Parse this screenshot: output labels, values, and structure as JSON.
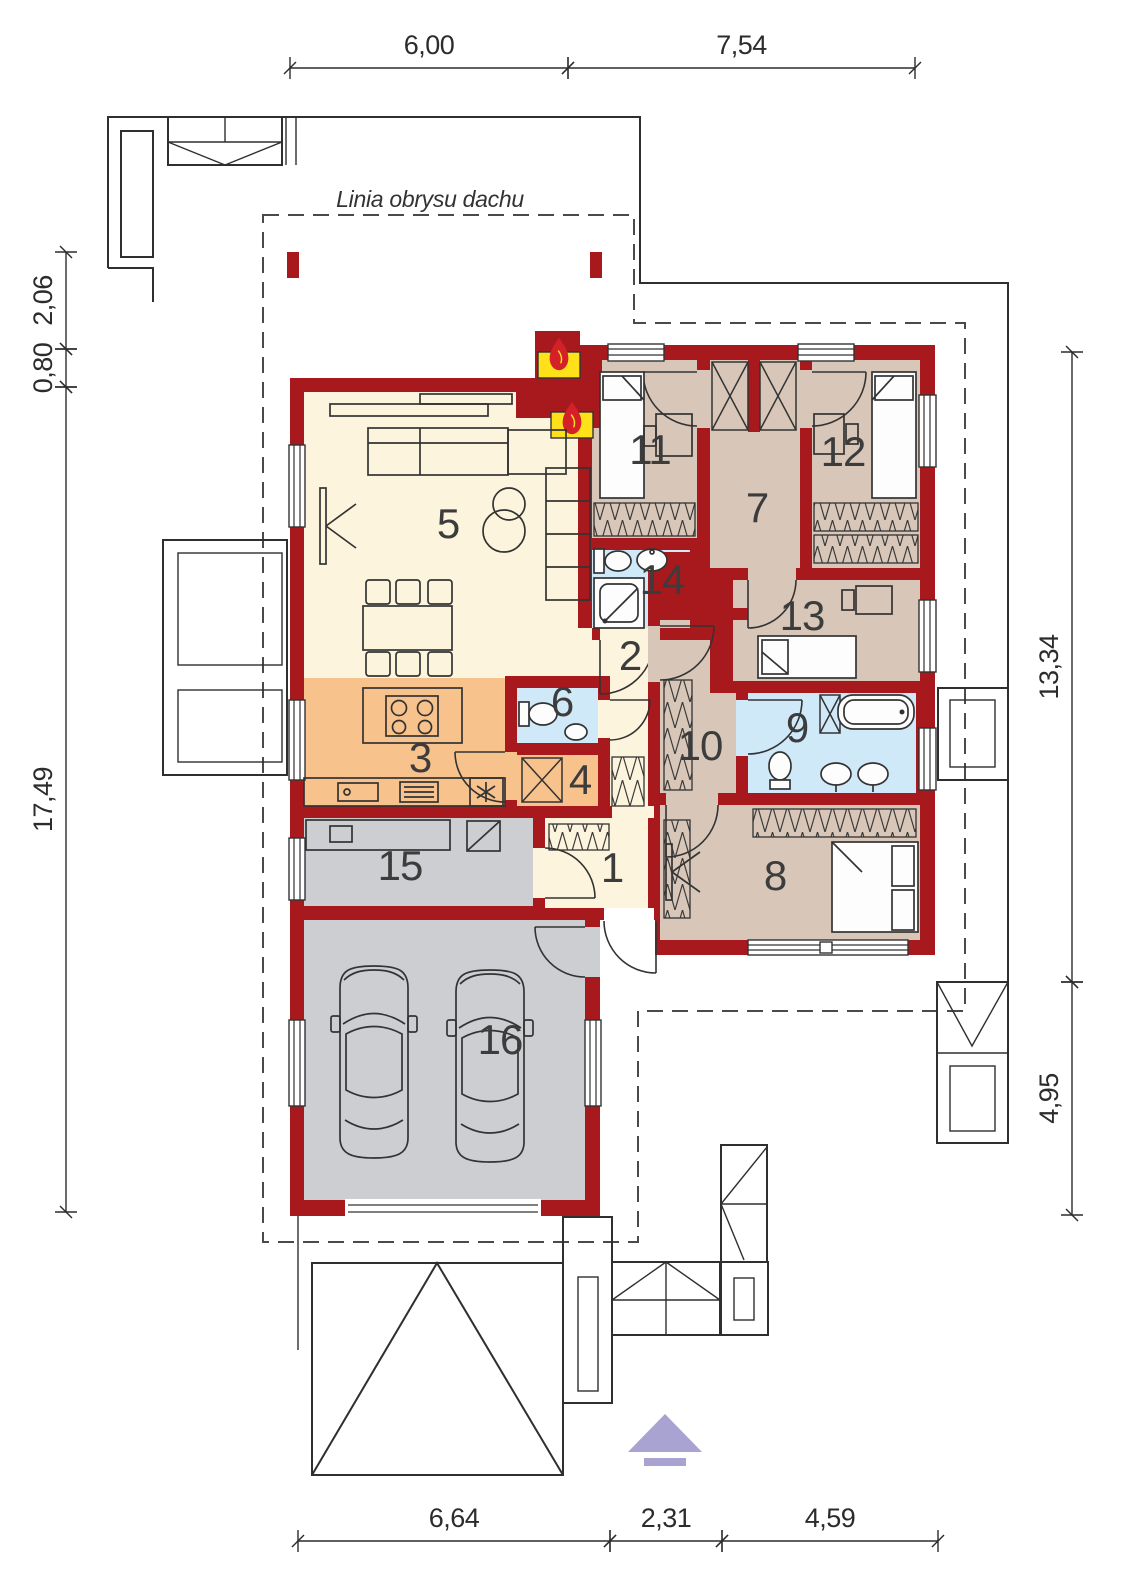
{
  "drawing_type": "house-floor-plan",
  "roof_label": "Linia obrysu dachu",
  "colors": {
    "wall": "#a8191d",
    "floor_living": "#fcf4dc",
    "floor_kitchen": "#f8c28c",
    "floor_bath": "#cfe9f9",
    "floor_bedroom": "#d8c7b8",
    "floor_garage": "#cdced1",
    "fireplace": "#ffe11a",
    "flame": "#d42027",
    "logo": "#a9a3d2"
  },
  "rooms": [
    {
      "number": "1",
      "x": 612,
      "y": 882
    },
    {
      "number": "2",
      "x": 630,
      "y": 670
    },
    {
      "number": "3",
      "x": 420,
      "y": 772
    },
    {
      "number": "4",
      "x": 580,
      "y": 794
    },
    {
      "number": "5",
      "x": 448,
      "y": 538
    },
    {
      "number": "6",
      "x": 562,
      "y": 716
    },
    {
      "number": "7",
      "x": 757,
      "y": 522
    },
    {
      "number": "8",
      "x": 775,
      "y": 890
    },
    {
      "number": "9",
      "x": 797,
      "y": 742
    },
    {
      "number": "10",
      "x": 700,
      "y": 760
    },
    {
      "number": "11",
      "x": 650,
      "y": 464
    },
    {
      "number": "12",
      "x": 843,
      "y": 466
    },
    {
      "number": "13",
      "x": 802,
      "y": 630
    },
    {
      "number": "14",
      "x": 662,
      "y": 594
    },
    {
      "number": "15",
      "x": 400,
      "y": 880
    },
    {
      "number": "16",
      "x": 500,
      "y": 1054
    }
  ],
  "dimensions": {
    "top": {
      "axis": "x",
      "at": 68,
      "segments": [
        {
          "label": "6,00",
          "from": 290,
          "to": 568
        },
        {
          "label": "7,54",
          "from": 568,
          "to": 915
        }
      ]
    },
    "bottom": {
      "axis": "x",
      "at": 1541,
      "segments": [
        {
          "label": "6,64",
          "from": 298,
          "to": 610
        },
        {
          "label": "2,31",
          "from": 610,
          "to": 722
        },
        {
          "label": "4,59",
          "from": 722,
          "to": 938
        }
      ]
    },
    "left": {
      "axis": "y",
      "at": 66,
      "segments": [
        {
          "label": "2,06",
          "from": 252,
          "to": 349
        },
        {
          "label": "0,80",
          "from": 349,
          "to": 387
        },
        {
          "label": "17,49",
          "from": 387,
          "to": 1212
        }
      ]
    },
    "right": {
      "axis": "y",
      "at": 1072,
      "segments": [
        {
          "label": "13,34",
          "from": 352,
          "to": 982
        },
        {
          "label": "4,95",
          "from": 982,
          "to": 1215
        }
      ]
    }
  }
}
